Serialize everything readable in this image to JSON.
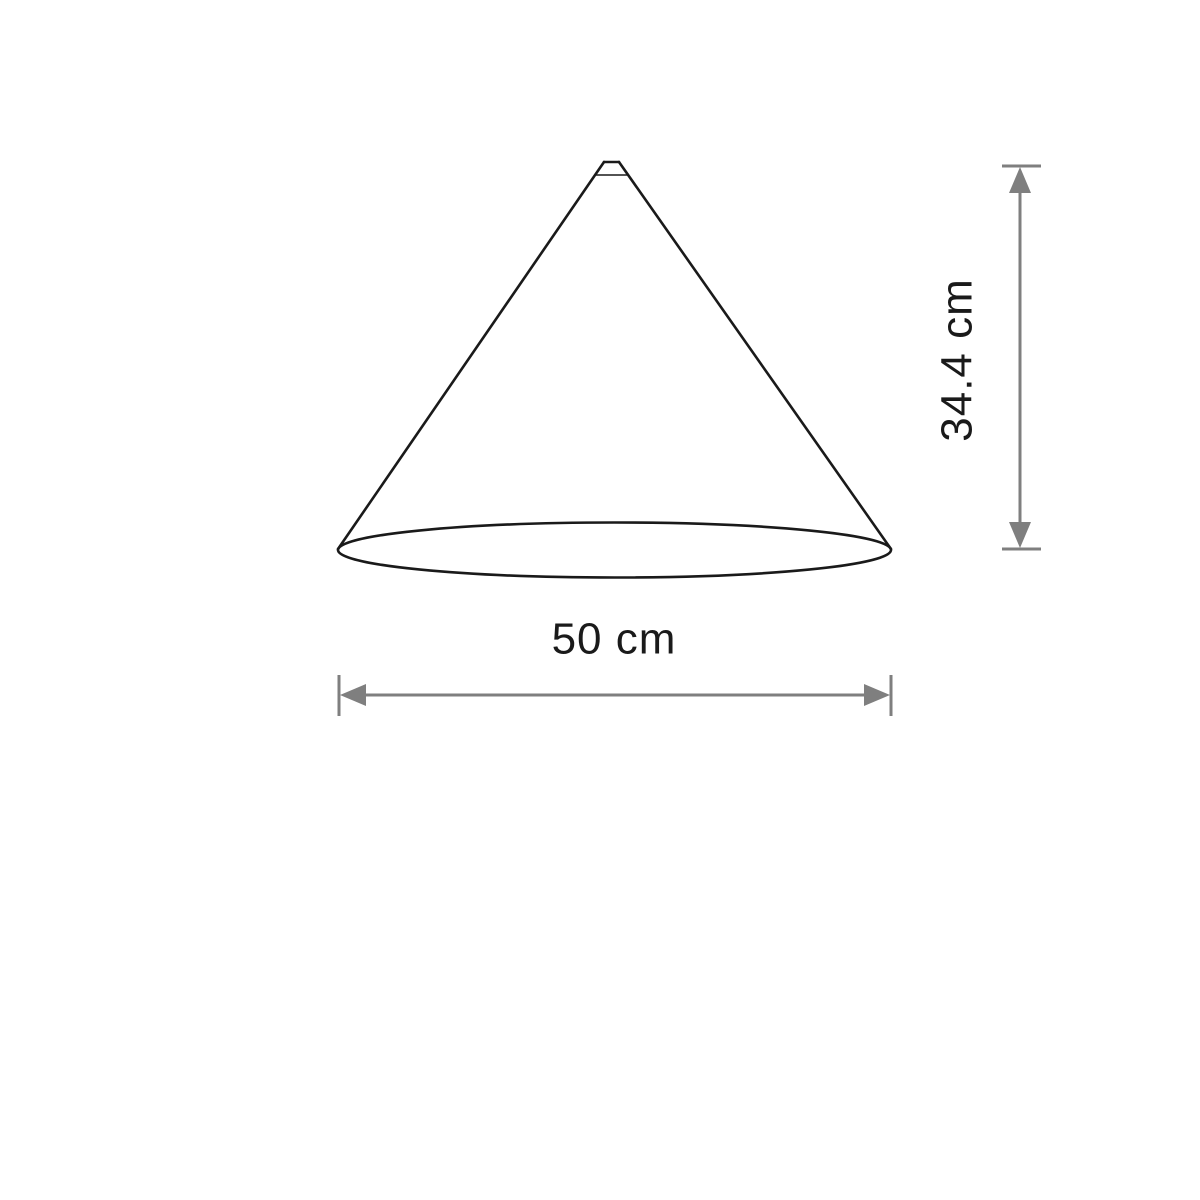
{
  "diagram": {
    "subject": "cone-lampshade-dimension-drawing",
    "colors": {
      "outline": "#1a1a1a",
      "dimension": "#7f7f7f",
      "text": "#1a1a1a",
      "background": "#ffffff"
    },
    "dimensions": {
      "height": {
        "label": "34.4 cm"
      },
      "width": {
        "label": "50 cm"
      }
    }
  }
}
